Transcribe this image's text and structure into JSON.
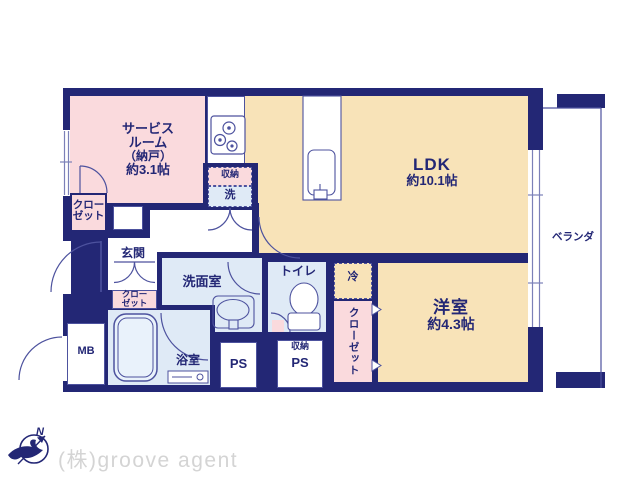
{
  "plan": {
    "rooms": {
      "service": {
        "lines": [
          "サービス",
          "ルーム",
          "（納戸）",
          "約3.1帖"
        ]
      },
      "ldk": {
        "name": "LDK",
        "size": "約10.1帖"
      },
      "western": {
        "name": "洋室",
        "size": "約4.3帖"
      },
      "veranda": {
        "label": "ベランダ"
      },
      "entrance": {
        "label": "玄関"
      },
      "washroom": {
        "label": "洗面室"
      },
      "toilet": {
        "label": "トイレ"
      },
      "bathroom": {
        "label": "浴室"
      },
      "closet_west": {
        "lines": [
          "クロー",
          "ゼット"
        ]
      },
      "closet_entrance": {
        "lines": [
          "クロー",
          "ゼット"
        ]
      },
      "closet_east": {
        "label": "クローゼット"
      },
      "fridge": {
        "label": "冷"
      },
      "kitchen_storage": {
        "label": "収納"
      },
      "laundry": {
        "label": "洗"
      },
      "meter_box": {
        "label": "MB"
      },
      "pipe_space_1": {
        "label": "PS"
      },
      "ps_storage": {
        "label": "収納"
      },
      "pipe_space_2": {
        "label": "PS"
      }
    },
    "compass": {
      "north": "N"
    },
    "branding": {
      "company": "(株)groove agent"
    },
    "colors": {
      "wall": "#232775",
      "room_cream": "#f8e3b8",
      "room_pink": "#fadadd",
      "room_blue": "#dfeaf6",
      "thin_line": "#4d529e",
      "text": "#232775",
      "watermark": "#d4d4d4"
    }
  }
}
